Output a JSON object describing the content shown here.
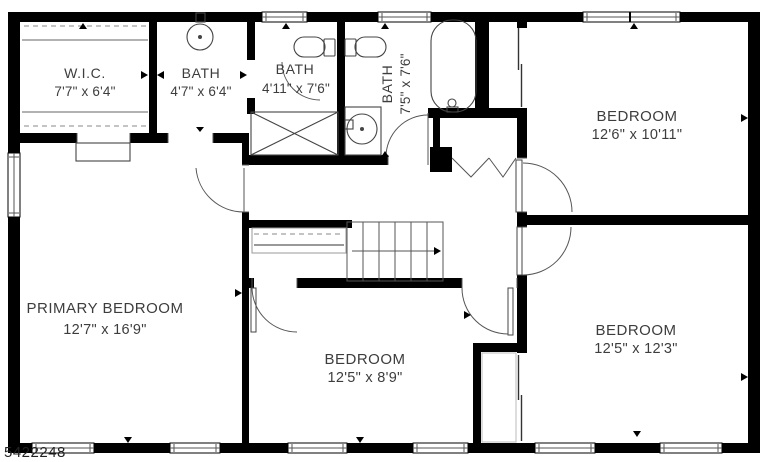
{
  "watermark": "5422248",
  "rooms": {
    "wic": {
      "name": "W.I.C.",
      "dims": "7'7\" x 6'4\""
    },
    "bath_ensuite": {
      "name": "BATH",
      "dims": "4'7\" x 6'4\""
    },
    "bath_hall": {
      "name": "BATH",
      "dims": "4'11\" x 7'6\""
    },
    "bath_right": {
      "name": "BATH",
      "dims": "7'5\" x 7'6\""
    },
    "bedroom_top_right": {
      "name": "BEDROOM",
      "dims": "12'6\" x 10'11\""
    },
    "primary_bedroom": {
      "name": "PRIMARY BEDROOM",
      "dims": "12'7\" x 16'9\""
    },
    "bedroom_bottom_center": {
      "name": "BEDROOM",
      "dims": "12'5\" x 8'9\""
    },
    "bedroom_bottom_right": {
      "name": "BEDROOM",
      "dims": "12'5\" x 12'3\""
    }
  },
  "colors": {
    "wall": "#000000",
    "label": "#3d3d3d",
    "background": "#ffffff"
  }
}
